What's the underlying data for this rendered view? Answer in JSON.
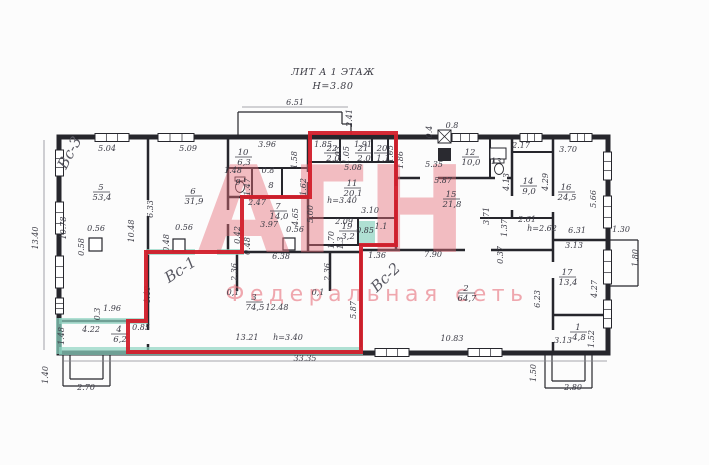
{
  "title": {
    "line1": "ЛИТ А 1 ЭТАЖ",
    "line2": "Н=3.80"
  },
  "watermark": {
    "big": "АГН",
    "sub": "Федеральная сеть",
    "color": "#e76f7b"
  },
  "red_outline": {
    "color": "#d21f2b",
    "points": "310,133 396,133 396,245 361,245 361,352 128,352 128,321 146,321 146,252 242,252 242,197 310,197"
  },
  "handwritten": [
    {
      "t": "Вс-3",
      "x": 74,
      "y": 155,
      "r": -62
    },
    {
      "t": "Вс-1",
      "x": 183,
      "y": 274,
      "r": -33
    },
    {
      "t": "Вс-2",
      "x": 389,
      "y": 281,
      "r": -44
    }
  ],
  "rooms": [
    {
      "num": "5",
      "area": "53,4",
      "x": 101,
      "y": 190
    },
    {
      "num": "6",
      "area": "31,9",
      "x": 193,
      "y": 194
    },
    {
      "num": "10",
      "area": "6,3",
      "x": 243,
      "y": 155
    },
    {
      "num": "9",
      "area": "",
      "x": 238,
      "y": 185
    },
    {
      "num": "8",
      "area": "",
      "x": 271,
      "y": 188
    },
    {
      "num": "7",
      "area": "14,0",
      "x": 278,
      "y": 209
    },
    {
      "num": "11",
      "area": "20,1",
      "x": 352,
      "y": 186
    },
    {
      "num": "22",
      "area": "2,0",
      "x": 332,
      "y": 151
    },
    {
      "num": "21",
      "area": "2,0",
      "x": 363,
      "y": 151
    },
    {
      "num": "20",
      "area": "1,1",
      "x": 382,
      "y": 151
    },
    {
      "num": "19",
      "area": "3,2",
      "x": 347,
      "y": 229
    },
    {
      "num": "12",
      "area": "10,0",
      "x": 470,
      "y": 155
    },
    {
      "num": "13",
      "area": "",
      "x": 496,
      "y": 164
    },
    {
      "num": "14",
      "area": "9,0",
      "x": 528,
      "y": 184
    },
    {
      "num": "15",
      "area": "21,8",
      "x": 451,
      "y": 197
    },
    {
      "num": "16",
      "area": "24,5",
      "x": 566,
      "y": 190
    },
    {
      "num": "17",
      "area": "13,4",
      "x": 567,
      "y": 275
    },
    {
      "num": "1",
      "area": "4,8",
      "x": 578,
      "y": 330
    },
    {
      "num": "2",
      "area": "64,7",
      "x": 466,
      "y": 291
    },
    {
      "num": "3",
      "area": "74,5",
      "x": 254,
      "y": 300
    },
    {
      "num": "4",
      "area": "6,2",
      "x": 119,
      "y": 332
    }
  ],
  "dims": [
    {
      "t": "6.51",
      "x": 295,
      "y": 105
    },
    {
      "t": "2.41",
      "x": 352,
      "y": 118,
      "v": 1
    },
    {
      "t": "5.04",
      "x": 107,
      "y": 151
    },
    {
      "t": "5.09",
      "x": 188,
      "y": 151
    },
    {
      "t": "3.96",
      "x": 267,
      "y": 147
    },
    {
      "t": "1.58",
      "x": 297,
      "y": 160,
      "v": 1
    },
    {
      "t": "1.48",
      "x": 233,
      "y": 173
    },
    {
      "t": "0.8",
      "x": 268,
      "y": 173
    },
    {
      "t": "1.47",
      "x": 250,
      "y": 187,
      "v": 1
    },
    {
      "t": "1.62",
      "x": 306,
      "y": 187,
      "v": 1
    },
    {
      "t": "1.85",
      "x": 323,
      "y": 147
    },
    {
      "t": "1.03",
      "x": 341,
      "y": 155,
      "v": 1
    },
    {
      "t": "1.05",
      "x": 349,
      "y": 155,
      "v": 1
    },
    {
      "t": "1.91",
      "x": 363,
      "y": 147
    },
    {
      "t": "1.05",
      "x": 393,
      "y": 154,
      "v": 1
    },
    {
      "t": "1.86",
      "x": 403,
      "y": 160,
      "v": 1
    },
    {
      "t": "5.08",
      "x": 353,
      "y": 170
    },
    {
      "t": "5.35",
      "x": 434,
      "y": 167
    },
    {
      "t": "0.8",
      "x": 452,
      "y": 128
    },
    {
      "t": "0.4",
      "x": 432,
      "y": 132,
      "v": 1
    },
    {
      "t": "2.17",
      "x": 521,
      "y": 148
    },
    {
      "t": "3.70",
      "x": 568,
      "y": 152
    },
    {
      "t": "4.13",
      "x": 509,
      "y": 182,
      "v": 1
    },
    {
      "t": "4.29",
      "x": 548,
      "y": 182,
      "v": 1
    },
    {
      "t": "5.66",
      "x": 596,
      "y": 199,
      "v": 1
    },
    {
      "t": "5.87",
      "x": 443,
      "y": 183
    },
    {
      "t": "3.71",
      "x": 489,
      "y": 216,
      "v": 1
    },
    {
      "t": "2.61",
      "x": 527,
      "y": 222
    },
    {
      "t": "h=2.62",
      "x": 542,
      "y": 231
    },
    {
      "t": "1.37",
      "x": 507,
      "y": 228,
      "v": 1
    },
    {
      "t": "0.37",
      "x": 503,
      "y": 255,
      "v": 1
    },
    {
      "t": "6.31",
      "x": 577,
      "y": 233
    },
    {
      "t": "3.13",
      "x": 574,
      "y": 248
    },
    {
      "t": "1.30",
      "x": 621,
      "y": 232
    },
    {
      "t": "1.80",
      "x": 638,
      "y": 258,
      "v": 1
    },
    {
      "t": "13.40",
      "x": 38,
      "y": 238,
      "v": 1
    },
    {
      "t": "10.78",
      "x": 66,
      "y": 228,
      "v": 1
    },
    {
      "t": "10.48",
      "x": 134,
      "y": 231,
      "v": 1
    },
    {
      "t": "6.33",
      "x": 153,
      "y": 209,
      "v": 1
    },
    {
      "t": "0.56",
      "x": 96,
      "y": 231
    },
    {
      "t": "0.58",
      "x": 84,
      "y": 247,
      "v": 1
    },
    {
      "t": "0.56",
      "x": 184,
      "y": 230
    },
    {
      "t": "0.48",
      "x": 169,
      "y": 243,
      "v": 1
    },
    {
      "t": "0.56",
      "x": 295,
      "y": 232
    },
    {
      "t": "0.42",
      "x": 240,
      "y": 235,
      "v": 1
    },
    {
      "t": "0.48",
      "x": 250,
      "y": 246,
      "v": 1
    },
    {
      "t": "2.47",
      "x": 257,
      "y": 205
    },
    {
      "t": "3.97",
      "x": 269,
      "y": 227
    },
    {
      "t": "4.65",
      "x": 298,
      "y": 217,
      "v": 1
    },
    {
      "t": "5.00",
      "x": 313,
      "y": 214,
      "v": 1
    },
    {
      "t": "h=3.40",
      "x": 342,
      "y": 203
    },
    {
      "t": "3.10",
      "x": 370,
      "y": 213
    },
    {
      "t": "2.09",
      "x": 344,
      "y": 224
    },
    {
      "t": "0.85",
      "x": 365,
      "y": 233
    },
    {
      "t": "1.1",
      "x": 381,
      "y": 229
    },
    {
      "t": "1.70",
      "x": 334,
      "y": 240,
      "v": 1
    },
    {
      "t": "1.3",
      "x": 343,
      "y": 243,
      "v": 1
    },
    {
      "t": "1.36",
      "x": 377,
      "y": 258
    },
    {
      "t": "7.90",
      "x": 433,
      "y": 257
    },
    {
      "t": "5.87",
      "x": 356,
      "y": 310,
      "v": 1
    },
    {
      "t": "2.36",
      "x": 237,
      "y": 272,
      "v": 1
    },
    {
      "t": "0,1",
      "x": 233,
      "y": 295
    },
    {
      "t": "2.36",
      "x": 330,
      "y": 272,
      "v": 1
    },
    {
      "t": "0,1",
      "x": 318,
      "y": 295
    },
    {
      "t": "1.96",
      "x": 112,
      "y": 311
    },
    {
      "t": "0.3",
      "x": 100,
      "y": 314,
      "v": 1
    },
    {
      "t": "4.22",
      "x": 91,
      "y": 332
    },
    {
      "t": "1.48",
      "x": 64,
      "y": 336,
      "v": 1
    },
    {
      "t": "0.85",
      "x": 141,
      "y": 330
    },
    {
      "t": "4.40",
      "x": 150,
      "y": 295,
      "v": 1
    },
    {
      "t": "12.48",
      "x": 277,
      "y": 310
    },
    {
      "t": "13.21",
      "x": 247,
      "y": 340
    },
    {
      "t": "h=3.40",
      "x": 288,
      "y": 340
    },
    {
      "t": "6.38",
      "x": 281,
      "y": 259
    },
    {
      "t": "33.35",
      "x": 305,
      "y": 361
    },
    {
      "t": "10.83",
      "x": 452,
      "y": 341
    },
    {
      "t": "6.23",
      "x": 540,
      "y": 299,
      "v": 1
    },
    {
      "t": "4.27",
      "x": 597,
      "y": 289,
      "v": 1
    },
    {
      "t": "3.13",
      "x": 563,
      "y": 343
    },
    {
      "t": "1.52",
      "x": 594,
      "y": 339,
      "v": 1
    },
    {
      "t": "1.50",
      "x": 536,
      "y": 373,
      "v": 1
    },
    {
      "t": "2.80",
      "x": 573,
      "y": 390
    },
    {
      "t": "1.40",
      "x": 48,
      "y": 375,
      "v": 1
    },
    {
      "t": "2.70",
      "x": 86,
      "y": 390
    }
  ],
  "geo": {
    "outer": {
      "x": 59,
      "y": 137,
      "w": 549,
      "h": 216,
      "sw": 5
    },
    "walls": [
      [
        148,
        137,
        148,
        353,
        2.5
      ],
      [
        228,
        137,
        228,
        252,
        2.5
      ],
      [
        228,
        168,
        308,
        168,
        2
      ],
      [
        252,
        168,
        252,
        197,
        2
      ],
      [
        282,
        168,
        282,
        197,
        2
      ],
      [
        228,
        197,
        308,
        197,
        2.5
      ],
      [
        308,
        137,
        308,
        252,
        2.5
      ],
      [
        308,
        162,
        396,
        162,
        2
      ],
      [
        340,
        137,
        340,
        162,
        2
      ],
      [
        372,
        137,
        372,
        162,
        2
      ],
      [
        388,
        137,
        388,
        162,
        2
      ],
      [
        396,
        137,
        396,
        250,
        2.5
      ],
      [
        308,
        218,
        396,
        218,
        2
      ],
      [
        308,
        245,
        396,
        245,
        2
      ],
      [
        358,
        218,
        358,
        245,
        2
      ],
      [
        361,
        250,
        361,
        353,
        2
      ],
      [
        146,
        252,
        361,
        252,
        2.5
      ],
      [
        361,
        250,
        553,
        250,
        2.5
      ],
      [
        553,
        137,
        553,
        353,
        2.5
      ],
      [
        396,
        178,
        512,
        178,
        2.5
      ],
      [
        490,
        137,
        490,
        178,
        2
      ],
      [
        512,
        137,
        512,
        218,
        2.5
      ],
      [
        512,
        152,
        553,
        152,
        2
      ],
      [
        480,
        218,
        553,
        218,
        2
      ],
      [
        553,
        240,
        608,
        240,
        2.5
      ],
      [
        553,
        315,
        608,
        315,
        2.5
      ],
      [
        59,
        321,
        146,
        321,
        2.5
      ],
      [
        237,
        252,
        237,
        291,
        2.5
      ],
      [
        330,
        252,
        330,
        291,
        2.5
      ]
    ],
    "gaps": [
      [
        145,
        200,
        6,
        16
      ],
      [
        145,
        330,
        6,
        14
      ],
      [
        225,
        210,
        6,
        14
      ],
      [
        305,
        172,
        6,
        10
      ],
      [
        393,
        186,
        6,
        14
      ],
      [
        550,
        196,
        6,
        16
      ],
      [
        550,
        262,
        6,
        16
      ],
      [
        550,
        330,
        6,
        12
      ],
      [
        420,
        175,
        18,
        6
      ],
      [
        465,
        247,
        26,
        6
      ],
      [
        195,
        249,
        22,
        6
      ],
      [
        495,
        175,
        12,
        6
      ],
      [
        509,
        196,
        6,
        14
      ]
    ],
    "teal": [
      [
        59,
        347,
        304,
        8
      ],
      [
        59,
        318,
        89,
        6
      ],
      [
        146,
        249,
        98,
        6
      ],
      [
        359,
        221,
        16,
        22
      ],
      [
        56,
        318,
        6,
        36
      ]
    ],
    "windows": [
      [
        55.5,
        150,
        8,
        26
      ],
      [
        55.5,
        202,
        8,
        32
      ],
      [
        55.5,
        256,
        8,
        32
      ],
      [
        55.5,
        298,
        8,
        16
      ],
      [
        95,
        133.5,
        34,
        8
      ],
      [
        158,
        133.5,
        36,
        8
      ],
      [
        452,
        133.5,
        26,
        8
      ],
      [
        520,
        133.5,
        22,
        8
      ],
      [
        570,
        133.5,
        22,
        8
      ],
      [
        603.5,
        152,
        8,
        28
      ],
      [
        603.5,
        196,
        8,
        32
      ],
      [
        603.5,
        250,
        8,
        34
      ],
      [
        603.5,
        300,
        8,
        28
      ],
      [
        375,
        348.5,
        34,
        8
      ],
      [
        468,
        348.5,
        34,
        8
      ]
    ],
    "columns": [
      [
        89,
        238,
        13,
        13
      ],
      [
        173,
        239,
        12,
        12
      ],
      [
        283,
        238,
        12,
        12
      ]
    ],
    "porch": [
      [
        238,
        136,
        238,
        112
      ],
      [
        238,
        112,
        342,
        112
      ],
      [
        342,
        112,
        342,
        124
      ],
      [
        342,
        124,
        351,
        124
      ],
      [
        351,
        124,
        351,
        136
      ],
      [
        63,
        355,
        63,
        386
      ],
      [
        63,
        386,
        110,
        386
      ],
      [
        110,
        386,
        110,
        355
      ],
      [
        70,
        355,
        70,
        379
      ],
      [
        70,
        379,
        103,
        379
      ],
      [
        103,
        379,
        103,
        355
      ],
      [
        545,
        355,
        545,
        388
      ],
      [
        545,
        388,
        592,
        388
      ],
      [
        592,
        388,
        592,
        355
      ],
      [
        552,
        355,
        552,
        381
      ],
      [
        552,
        381,
        585,
        381
      ],
      [
        585,
        355,
        585,
        381
      ],
      [
        610,
        240,
        638,
        240
      ],
      [
        638,
        240,
        638,
        286
      ],
      [
        610,
        286,
        638,
        286
      ]
    ],
    "thin": [
      [
        44,
        140,
        44,
        350
      ],
      [
        64,
        361,
        607,
        361
      ],
      [
        242,
        107,
        348,
        107
      ]
    ],
    "crossbox": [
      438,
      130,
      13,
      13
    ],
    "darkbox": [
      438,
      148,
      13,
      13
    ],
    "sink": [
      490,
      148,
      16,
      11
    ],
    "toilets": [
      {
        "x": 240,
        "y": 187
      },
      {
        "x": 499,
        "y": 169
      }
    ]
  }
}
